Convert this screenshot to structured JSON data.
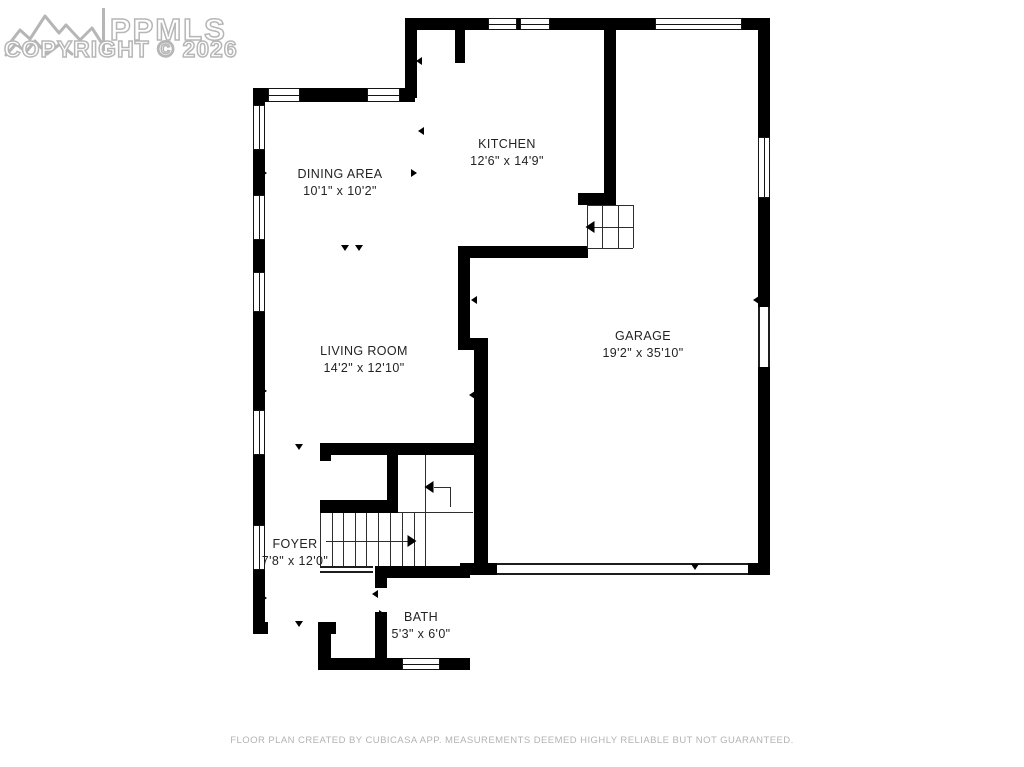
{
  "watermark": {
    "logo": "mountain-range-logo",
    "brand": "PPMLS",
    "copyright": "COPYRIGHT © 2026"
  },
  "footer": {
    "disclaimer": "FLOOR PLAN CREATED BY CUBICASA APP. MEASUREMENTS DEEMED HIGHLY RELIABLE BUT NOT GUARANTEED."
  },
  "floor_plan": {
    "colors": {
      "wall": "#000000",
      "thin_line": "#2e2e2e",
      "label_text": "#232323",
      "watermark": "#b6b6b6",
      "footer_text": "#b3b3b3",
      "background": "#ffffff"
    },
    "rooms": [
      {
        "id": "kitchen",
        "name": "KITCHEN",
        "dims": "12'6\" x 14'9\"",
        "cx": 507,
        "cy": 153
      },
      {
        "id": "dining-area",
        "name": "DINING AREA",
        "dims": "10'1\" x 10'2\"",
        "cx": 340,
        "cy": 183
      },
      {
        "id": "living-room",
        "name": "LIVING ROOM",
        "dims": "14'2\" x 12'10\"",
        "cx": 364,
        "cy": 360
      },
      {
        "id": "garage",
        "name": "GARAGE",
        "dims": "19'2\" x 35'10\"",
        "cx": 643,
        "cy": 345
      },
      {
        "id": "foyer",
        "name": "FOYER",
        "dims": "7'8\" x 12'0\"",
        "cx": 295,
        "cy": 553
      },
      {
        "id": "bath",
        "name": "BATH",
        "dims": "5'3\" x 6'0\"",
        "cx": 421,
        "cy": 626
      }
    ],
    "walls": [
      [
        405,
        18,
        365,
        12
      ],
      [
        405,
        30,
        12,
        68
      ],
      [
        253,
        88,
        162,
        14
      ],
      [
        253,
        95,
        12,
        539
      ],
      [
        455,
        30,
        10,
        33
      ],
      [
        604,
        30,
        12,
        165
      ],
      [
        578,
        193,
        38,
        12
      ],
      [
        458,
        246,
        130,
        12
      ],
      [
        458,
        246,
        12,
        104
      ],
      [
        458,
        338,
        30,
        12
      ],
      [
        474,
        338,
        14,
        227
      ],
      [
        758,
        18,
        12,
        557
      ],
      [
        748,
        563,
        22,
        12
      ],
      [
        320,
        443,
        154,
        12
      ],
      [
        320,
        443,
        11,
        18
      ],
      [
        320,
        500,
        78,
        13
      ],
      [
        387,
        455,
        11,
        58
      ],
      [
        460,
        563,
        37,
        12
      ],
      [
        375,
        566,
        95,
        12
      ],
      [
        375,
        566,
        12,
        22
      ],
      [
        375,
        612,
        12,
        50
      ],
      [
        318,
        658,
        152,
        12
      ],
      [
        318,
        622,
        13,
        48
      ],
      [
        318,
        622,
        18,
        12
      ],
      [
        253,
        622,
        15,
        12
      ]
    ],
    "windows": [
      {
        "x": 488,
        "y": 18,
        "w": 29,
        "h": 12,
        "o": "h"
      },
      {
        "x": 520,
        "y": 18,
        "w": 30,
        "h": 12,
        "o": "h"
      },
      {
        "x": 655,
        "y": 18,
        "w": 87,
        "h": 12,
        "o": "h"
      },
      {
        "x": 268,
        "y": 88,
        "w": 32,
        "h": 14,
        "o": "h"
      },
      {
        "x": 367,
        "y": 88,
        "w": 33,
        "h": 14,
        "o": "h"
      },
      {
        "x": 253,
        "y": 105,
        "w": 12,
        "h": 45,
        "o": "v"
      },
      {
        "x": 253,
        "y": 195,
        "w": 12,
        "h": 45,
        "o": "v"
      },
      {
        "x": 253,
        "y": 272,
        "w": 12,
        "h": 40,
        "o": "v"
      },
      {
        "x": 253,
        "y": 410,
        "w": 12,
        "h": 45,
        "o": "v"
      },
      {
        "x": 253,
        "y": 525,
        "w": 12,
        "h": 45,
        "o": "v"
      },
      {
        "x": 758,
        "y": 137,
        "w": 12,
        "h": 61,
        "o": "v"
      },
      {
        "x": 402,
        "y": 658,
        "w": 38,
        "h": 12,
        "o": "h"
      }
    ],
    "openings": [
      {
        "x": 758,
        "y": 307,
        "w": 12,
        "h": 60,
        "o": "v",
        "name": "garage-side-door-opening"
      },
      {
        "x": 497,
        "y": 563,
        "w": 251,
        "h": 12,
        "o": "h",
        "name": "garage-door-opening"
      },
      {
        "x": 320,
        "y": 566,
        "w": 53,
        "h": 7,
        "o": "h",
        "name": "stair-base-edge"
      }
    ],
    "stair_lines": [
      [
        320,
        513,
        320,
        566
      ],
      [
        332,
        513,
        332,
        566
      ],
      [
        343,
        513,
        343,
        566
      ],
      [
        355,
        513,
        355,
        566
      ],
      [
        366,
        513,
        366,
        566
      ],
      [
        378,
        513,
        378,
        566
      ],
      [
        390,
        513,
        390,
        566
      ],
      [
        402,
        513,
        402,
        566
      ],
      [
        414,
        513,
        414,
        566
      ],
      [
        425,
        455,
        425,
        566
      ],
      [
        398,
        512,
        473,
        512
      ],
      [
        450,
        487,
        450,
        507
      ],
      [
        434,
        487,
        450,
        487
      ],
      [
        326,
        541,
        410,
        541
      ],
      [
        587,
        205,
        633,
        205
      ],
      [
        587,
        248,
        633,
        248
      ],
      [
        587,
        205,
        587,
        248
      ],
      [
        633,
        205,
        633,
        248
      ],
      [
        602,
        205,
        602,
        248
      ],
      [
        618,
        205,
        618,
        248
      ],
      [
        594,
        227,
        633,
        227
      ]
    ],
    "markers": [
      {
        "x": 299,
        "y": 447,
        "d": "down"
      },
      {
        "x": 299,
        "y": 624,
        "d": "down"
      },
      {
        "x": 519,
        "y": 250,
        "d": "down"
      },
      {
        "x": 345,
        "y": 248,
        "d": "down"
      },
      {
        "x": 359,
        "y": 248,
        "d": "down"
      },
      {
        "x": 419,
        "y": 61,
        "d": "left"
      },
      {
        "x": 421,
        "y": 131,
        "d": "left"
      },
      {
        "x": 414,
        "y": 173,
        "d": "right"
      },
      {
        "x": 264,
        "y": 173,
        "d": "right"
      },
      {
        "x": 264,
        "y": 391,
        "d": "right"
      },
      {
        "x": 264,
        "y": 598,
        "d": "right"
      },
      {
        "x": 474,
        "y": 300,
        "d": "left"
      },
      {
        "x": 472,
        "y": 395,
        "d": "left"
      },
      {
        "x": 756,
        "y": 300,
        "d": "left"
      },
      {
        "x": 695,
        "y": 567,
        "d": "down"
      },
      {
        "x": 375,
        "y": 594,
        "d": "left"
      },
      {
        "x": 382,
        "y": 614,
        "d": "right"
      },
      {
        "x": 412,
        "y": 541,
        "d": "right",
        "big": true
      },
      {
        "x": 429,
        "y": 487,
        "d": "left",
        "big": true
      },
      {
        "x": 590,
        "y": 227,
        "d": "left",
        "big": true
      }
    ]
  }
}
